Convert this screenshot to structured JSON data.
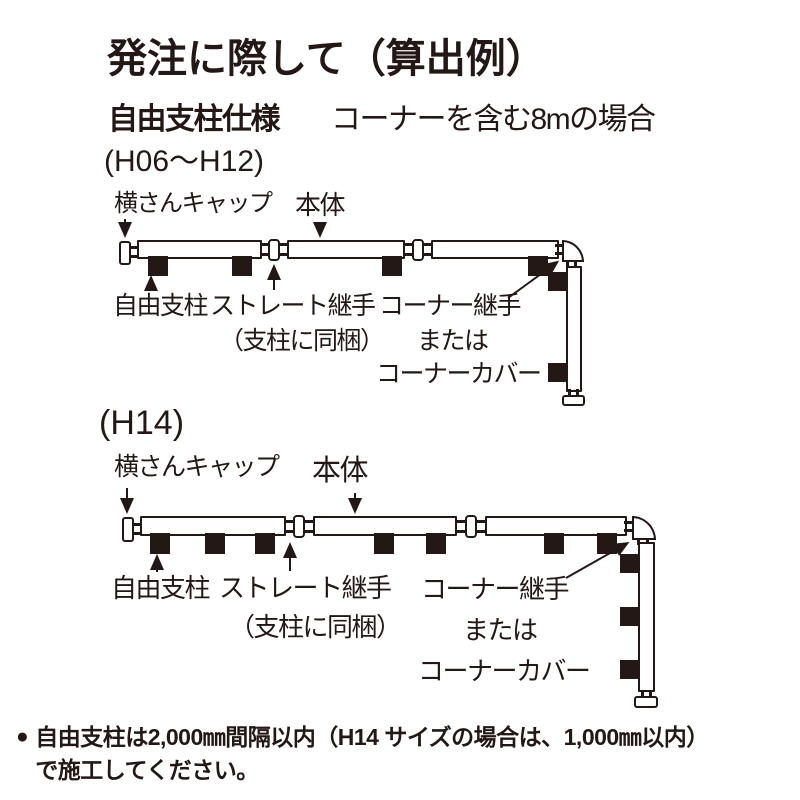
{
  "colors": {
    "ink": "#231815",
    "paper": "#ffffff"
  },
  "header": {
    "title": "発注に際して（算出例）",
    "subtitle_bold": "自由支柱仕様",
    "subtitle_rest": "コーナーを含む8mの場合"
  },
  "diagram1": {
    "size_label": "(H06〜H12)",
    "labels": {
      "cap": "横さんキャップ",
      "body": "本体",
      "free_post": "自由支柱",
      "straight_joint": "ストレート継手",
      "straight_joint_note": "（支柱に同梱）",
      "corner_joint": "コーナー継手",
      "or": "または",
      "corner_cover": "コーナーカバー"
    }
  },
  "diagram2": {
    "size_label": "(H14)",
    "labels": {
      "cap": "横さんキャップ",
      "body": "本体",
      "free_post": "自由支柱",
      "straight_joint": "ストレート継手",
      "straight_joint_note": "（支柱に同梱）",
      "corner_joint": "コーナー継手",
      "or": "または",
      "corner_cover": "コーナーカバー"
    }
  },
  "footnote": {
    "bullet": "●",
    "line1": "自由支柱は2,000㎜間隔以内（H14 サイズの場合は、1,000㎜以内）",
    "line2": "で施工してください。"
  }
}
